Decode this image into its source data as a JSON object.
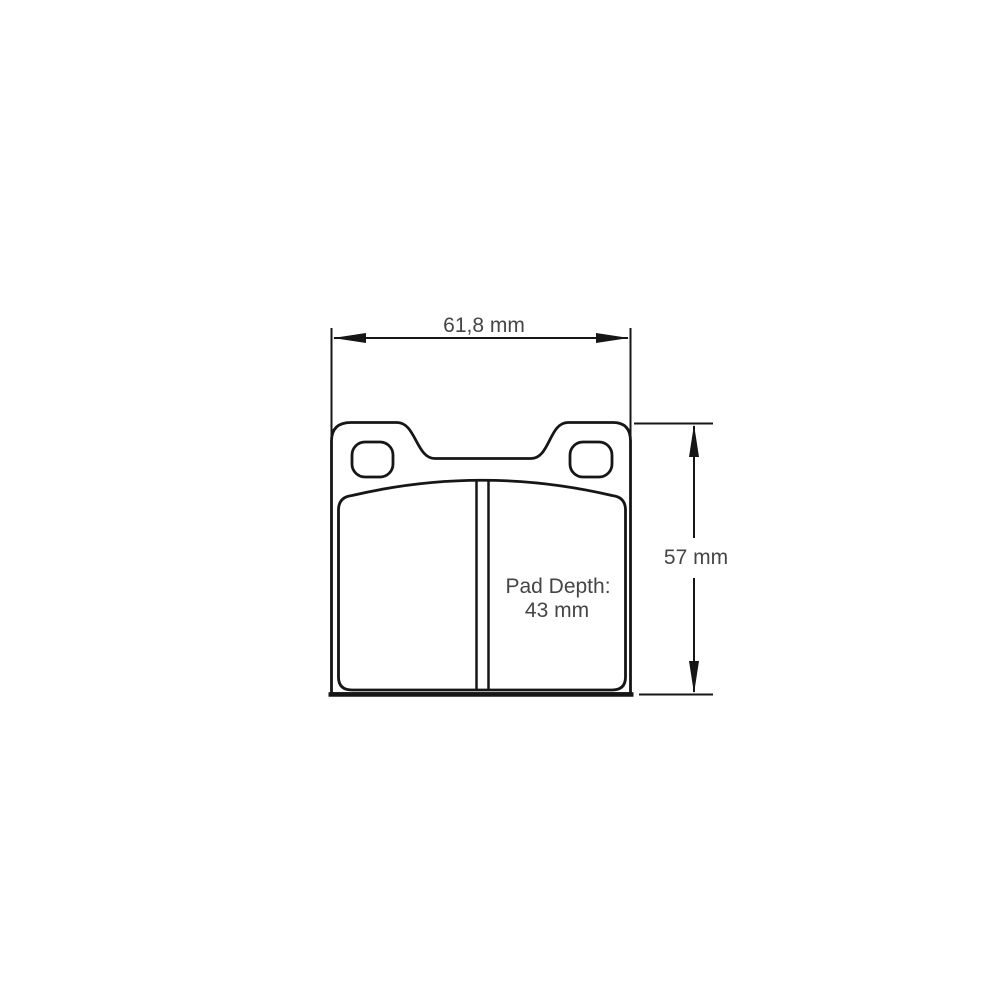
{
  "page": {
    "background": "#ffffff"
  },
  "diagram": {
    "type": "technical-dimension-drawing",
    "subject": "brake pad front view",
    "colors": {
      "line": "#161616",
      "text": "#454545",
      "fill": "#ffffff"
    },
    "dimensions": {
      "width": {
        "label": "61,8 mm"
      },
      "height": {
        "label": "57 mm"
      },
      "pad_depth": {
        "line1": "Pad Depth:",
        "line2": "43 mm"
      }
    }
  }
}
